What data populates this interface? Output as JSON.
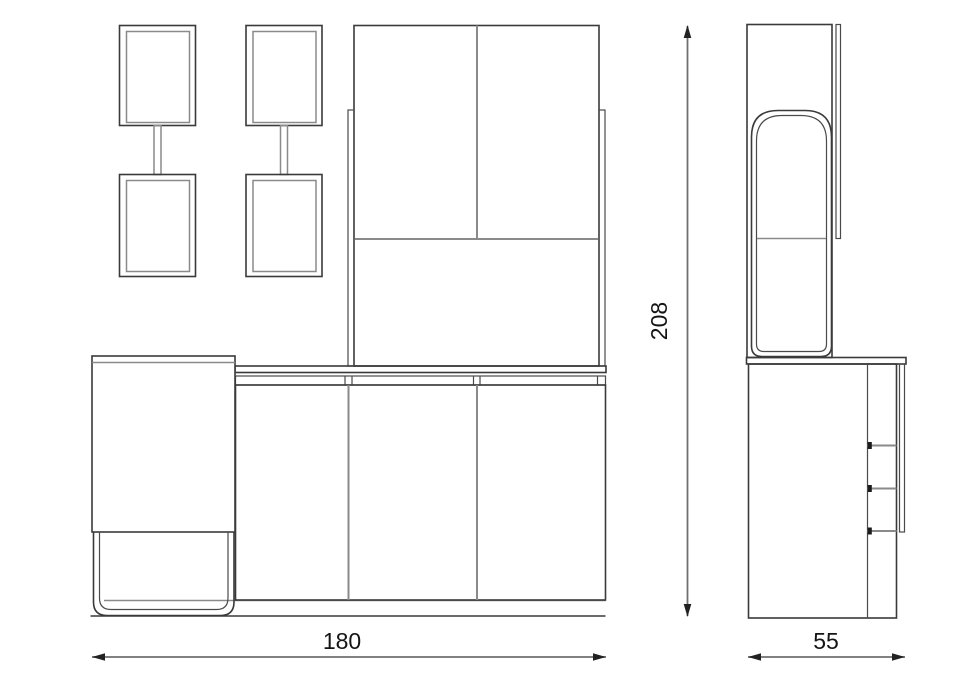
{
  "drawing": {
    "type": "furniture-elevation-technical-drawing",
    "views": [
      "front",
      "side"
    ]
  },
  "dimensions": {
    "width_label": "180",
    "height_label": "208",
    "depth_label": "55"
  },
  "colors": {
    "background": "#ffffff",
    "line_dark": "#3a3a3a",
    "line_gray": "#8a8a8a",
    "dimension_line": "#6f6f6f",
    "text": "#141414"
  }
}
